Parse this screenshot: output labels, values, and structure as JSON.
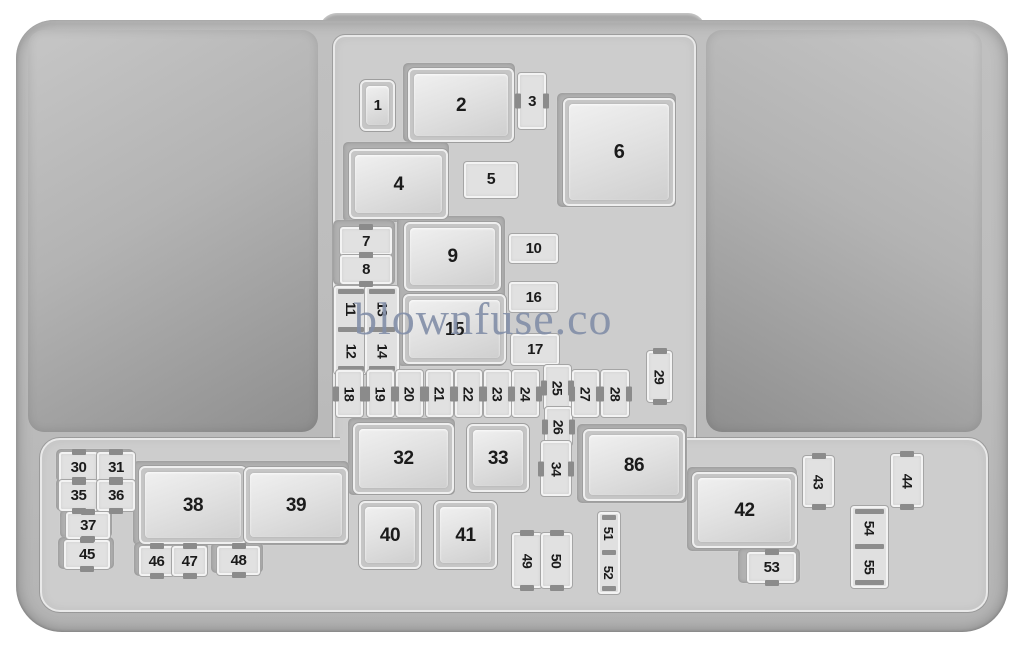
{
  "watermark": "blownfuse.co",
  "colors": {
    "background": "#ffffff",
    "body_gray": "#bcbcbc",
    "panel_light": "#cdcdcd",
    "cover_dark": "#8e8e8e",
    "fuse_fill": "#e1e1e1",
    "number_color": "#1b1b1b",
    "watermark_color": "#8490a9"
  },
  "diagram": {
    "plates": [
      {
        "x": 403,
        "y": 63,
        "w": 112,
        "h": 79
      },
      {
        "x": 343,
        "y": 142,
        "w": 106,
        "h": 80
      },
      {
        "x": 557,
        "y": 93,
        "w": 119,
        "h": 114
      },
      {
        "x": 333,
        "y": 220,
        "w": 62,
        "h": 65
      },
      {
        "x": 397,
        "y": 216,
        "w": 108,
        "h": 150
      },
      {
        "x": 348,
        "y": 418,
        "w": 107,
        "h": 77
      },
      {
        "x": 577,
        "y": 424,
        "w": 110,
        "h": 79
      },
      {
        "x": 56,
        "y": 449,
        "w": 78,
        "h": 33
      },
      {
        "x": 56,
        "y": 478,
        "w": 78,
        "h": 33
      },
      {
        "x": 60,
        "y": 509,
        "w": 52,
        "h": 29
      },
      {
        "x": 58,
        "y": 537,
        "w": 56,
        "h": 32
      },
      {
        "x": 133,
        "y": 461,
        "w": 216,
        "h": 84
      },
      {
        "x": 134,
        "y": 542,
        "w": 74,
        "h": 34
      },
      {
        "x": 211,
        "y": 542,
        "w": 52,
        "h": 31
      },
      {
        "x": 687,
        "y": 467,
        "w": 110,
        "h": 84
      },
      {
        "x": 738,
        "y": 548,
        "w": 62,
        "h": 35
      }
    ],
    "elements": [
      {
        "id": "1",
        "label": "1",
        "kind": "relay",
        "x": 360,
        "y": 80,
        "w": 31,
        "h": 47,
        "fs": 15
      },
      {
        "id": "2",
        "label": "2",
        "kind": "relay",
        "x": 408,
        "y": 68,
        "w": 102,
        "h": 70,
        "fs": 19
      },
      {
        "id": "3",
        "label": "3",
        "kind": "fuse",
        "tabs": "lr",
        "x": 518,
        "y": 73,
        "w": 24,
        "h": 52,
        "fs": 15
      },
      {
        "id": "4",
        "label": "4",
        "kind": "relay",
        "x": 349,
        "y": 149,
        "w": 95,
        "h": 66,
        "fs": 19
      },
      {
        "id": "5",
        "label": "5",
        "kind": "box",
        "x": 464,
        "y": 162,
        "w": 50,
        "h": 32,
        "fs": 16
      },
      {
        "id": "6",
        "label": "6",
        "kind": "relay",
        "x": 563,
        "y": 98,
        "w": 108,
        "h": 104,
        "fs": 20
      },
      {
        "id": "7",
        "label": "7",
        "kind": "fuse",
        "tabs": "tb",
        "x": 340,
        "y": 227,
        "w": 48,
        "h": 24,
        "fs": 15
      },
      {
        "id": "8",
        "label": "8",
        "kind": "fuse",
        "tabs": "tb",
        "x": 340,
        "y": 255,
        "w": 48,
        "h": 25,
        "fs": 15
      },
      {
        "id": "9",
        "label": "9",
        "kind": "relay",
        "x": 404,
        "y": 222,
        "w": 93,
        "h": 65,
        "fs": 19
      },
      {
        "id": "10",
        "label": "10",
        "kind": "box",
        "x": 509,
        "y": 234,
        "w": 45,
        "h": 25,
        "fs": 15
      },
      {
        "id": "16",
        "label": "16",
        "kind": "box",
        "x": 509,
        "y": 282,
        "w": 45,
        "h": 26,
        "fs": 15
      },
      {
        "id": "15",
        "label": "15",
        "kind": "relay",
        "x": 403,
        "y": 294,
        "w": 99,
        "h": 66,
        "fs": 18
      },
      {
        "id": "17",
        "label": "17",
        "kind": "box",
        "x": 511,
        "y": 334,
        "w": 44,
        "h": 27,
        "fs": 15
      },
      {
        "id": "11-12",
        "labels": [
          "11",
          "12"
        ],
        "kind": "vcol",
        "x": 334,
        "y": 286,
        "w": 30,
        "h": 84,
        "fs": 14
      },
      {
        "id": "13-14",
        "labels": [
          "13",
          "14"
        ],
        "kind": "vcol",
        "x": 365,
        "y": 286,
        "w": 30,
        "h": 84,
        "fs": 14
      },
      {
        "id": "18",
        "label": "18",
        "kind": "fuse",
        "tabs": "lr",
        "rot": true,
        "x": 336,
        "y": 370,
        "w": 23,
        "h": 43,
        "fs": 14
      },
      {
        "id": "19",
        "label": "19",
        "kind": "fuse",
        "tabs": "lr",
        "rot": true,
        "x": 367,
        "y": 370,
        "w": 23,
        "h": 43,
        "fs": 14
      },
      {
        "id": "20",
        "label": "20",
        "kind": "fuse",
        "tabs": "lr",
        "rot": true,
        "x": 396,
        "y": 370,
        "w": 23,
        "h": 43,
        "fs": 14
      },
      {
        "id": "21",
        "label": "21",
        "kind": "fuse",
        "tabs": "lr",
        "rot": true,
        "x": 426,
        "y": 370,
        "w": 23,
        "h": 43,
        "fs": 14
      },
      {
        "id": "22",
        "label": "22",
        "kind": "fuse",
        "tabs": "lr",
        "rot": true,
        "x": 455,
        "y": 370,
        "w": 23,
        "h": 43,
        "fs": 14
      },
      {
        "id": "23",
        "label": "23",
        "kind": "fuse",
        "tabs": "lr",
        "rot": true,
        "x": 484,
        "y": 370,
        "w": 23,
        "h": 43,
        "fs": 14
      },
      {
        "id": "24",
        "label": "24",
        "kind": "fuse",
        "tabs": "lr",
        "rot": true,
        "x": 512,
        "y": 370,
        "w": 23,
        "h": 43,
        "fs": 14
      },
      {
        "id": "25",
        "label": "25",
        "kind": "fuse",
        "tabs": "lr",
        "rot": true,
        "x": 544,
        "y": 365,
        "w": 23,
        "h": 41,
        "fs": 14
      },
      {
        "id": "26",
        "label": "26",
        "kind": "fuse",
        "tabs": "lr",
        "rot": true,
        "x": 545,
        "y": 407,
        "w": 23,
        "h": 35,
        "fs": 14
      },
      {
        "id": "27",
        "label": "27",
        "kind": "fuse",
        "tabs": "lr",
        "rot": true,
        "x": 572,
        "y": 370,
        "w": 23,
        "h": 43,
        "fs": 14
      },
      {
        "id": "28",
        "label": "28",
        "kind": "fuse",
        "tabs": "lr",
        "rot": true,
        "x": 601,
        "y": 370,
        "w": 24,
        "h": 43,
        "fs": 14
      },
      {
        "id": "29",
        "label": "29",
        "kind": "fuse",
        "tabs": "tb",
        "rot": true,
        "x": 647,
        "y": 351,
        "w": 21,
        "h": 47,
        "fs": 14
      },
      {
        "id": "32",
        "label": "32",
        "kind": "relay",
        "x": 353,
        "y": 423,
        "w": 97,
        "h": 67,
        "fs": 19
      },
      {
        "id": "33",
        "label": "33",
        "kind": "relay",
        "x": 467,
        "y": 424,
        "w": 58,
        "h": 64,
        "fs": 19
      },
      {
        "id": "34",
        "label": "34",
        "kind": "fuse",
        "tabs": "lr",
        "rot": true,
        "x": 541,
        "y": 441,
        "w": 26,
        "h": 51,
        "fs": 14
      },
      {
        "id": "86",
        "label": "86",
        "kind": "relay",
        "x": 583,
        "y": 429,
        "w": 98,
        "h": 68,
        "fs": 19
      },
      {
        "id": "40",
        "label": "40",
        "kind": "relay",
        "x": 359,
        "y": 501,
        "w": 58,
        "h": 64,
        "fs": 19
      },
      {
        "id": "41",
        "label": "41",
        "kind": "relay",
        "x": 434,
        "y": 501,
        "w": 59,
        "h": 64,
        "fs": 19
      },
      {
        "id": "49",
        "label": "49",
        "kind": "fuse",
        "tabs": "tb",
        "rot": true,
        "x": 512,
        "y": 533,
        "w": 26,
        "h": 51,
        "fs": 14
      },
      {
        "id": "50",
        "label": "50",
        "kind": "fuse",
        "tabs": "tb",
        "rot": true,
        "x": 541,
        "y": 533,
        "w": 27,
        "h": 51,
        "fs": 14
      },
      {
        "id": "51-52",
        "labels": [
          "51",
          "52"
        ],
        "kind": "vcol",
        "x": 598,
        "y": 512,
        "w": 18,
        "h": 78,
        "fs": 13
      },
      {
        "id": "54-55",
        "labels": [
          "54",
          "55"
        ],
        "kind": "vcol",
        "x": 851,
        "y": 506,
        "w": 33,
        "h": 78,
        "fs": 14
      },
      {
        "id": "30",
        "label": "30",
        "kind": "fuse",
        "tabs": "tb",
        "x": 59,
        "y": 452,
        "w": 35,
        "h": 26,
        "fs": 15
      },
      {
        "id": "31",
        "label": "31",
        "kind": "fuse",
        "tabs": "tb",
        "x": 97,
        "y": 452,
        "w": 34,
        "h": 26,
        "fs": 15
      },
      {
        "id": "35",
        "label": "35",
        "kind": "fuse",
        "tabs": "tb",
        "x": 59,
        "y": 480,
        "w": 35,
        "h": 27,
        "fs": 15
      },
      {
        "id": "36",
        "label": "36",
        "kind": "fuse",
        "tabs": "tb",
        "x": 97,
        "y": 480,
        "w": 34,
        "h": 27,
        "fs": 15
      },
      {
        "id": "37",
        "label": "37",
        "kind": "fuse",
        "tabs": "tb",
        "x": 66,
        "y": 512,
        "w": 40,
        "h": 23,
        "fs": 15
      },
      {
        "id": "45",
        "label": "45",
        "kind": "fuse",
        "tabs": "tb",
        "x": 64,
        "y": 540,
        "w": 42,
        "h": 25,
        "fs": 15
      },
      {
        "id": "38",
        "label": "38",
        "kind": "relay",
        "x": 139,
        "y": 466,
        "w": 104,
        "h": 74,
        "fs": 19
      },
      {
        "id": "39",
        "label": "39",
        "kind": "relay",
        "x": 244,
        "y": 467,
        "w": 100,
        "h": 72,
        "fs": 19
      },
      {
        "id": "46",
        "label": "46",
        "kind": "fuse",
        "tabs": "tb",
        "x": 139,
        "y": 546,
        "w": 31,
        "h": 26,
        "fs": 15
      },
      {
        "id": "47",
        "label": "47",
        "kind": "fuse",
        "tabs": "tb",
        "x": 172,
        "y": 546,
        "w": 31,
        "h": 26,
        "fs": 15
      },
      {
        "id": "48",
        "label": "48",
        "kind": "fuse",
        "tabs": "tb",
        "x": 217,
        "y": 546,
        "w": 39,
        "h": 25,
        "fs": 15
      },
      {
        "id": "42",
        "label": "42",
        "kind": "relay",
        "x": 692,
        "y": 472,
        "w": 101,
        "h": 72,
        "fs": 19
      },
      {
        "id": "43",
        "label": "43",
        "kind": "fuse",
        "tabs": "tb",
        "rot": true,
        "x": 803,
        "y": 456,
        "w": 27,
        "h": 47,
        "fs": 14
      },
      {
        "id": "44",
        "label": "44",
        "kind": "fuse",
        "tabs": "tb",
        "rot": true,
        "x": 891,
        "y": 454,
        "w": 28,
        "h": 49,
        "fs": 14
      },
      {
        "id": "53",
        "label": "53",
        "kind": "fuse",
        "tabs": "tb",
        "x": 747,
        "y": 552,
        "w": 45,
        "h": 27,
        "fs": 15
      }
    ]
  }
}
